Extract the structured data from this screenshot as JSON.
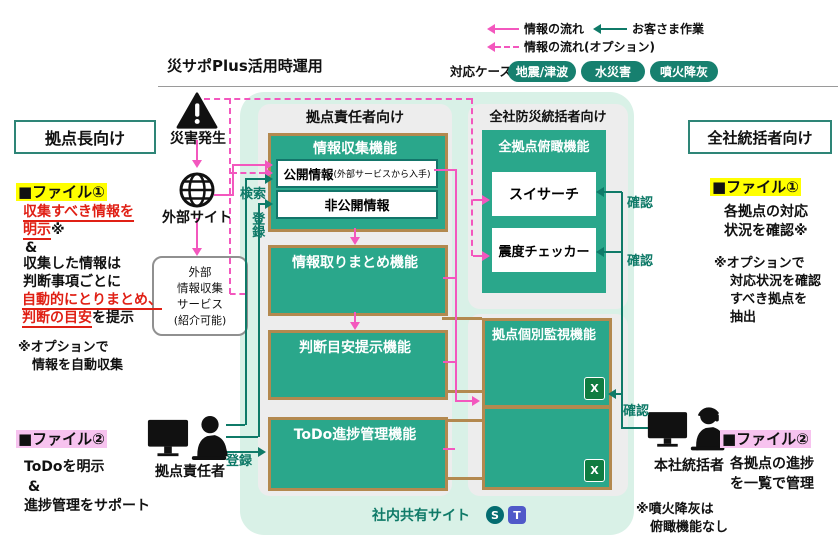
{
  "title": "災サポPlus活用時運用",
  "legend": {
    "info_flow": "情報の流れ",
    "customer_work": "お客さま作業",
    "info_flow_option": "情報の流れ(オプション)",
    "cases_label": "対応ケース：",
    "cases": [
      "地震/津波",
      "水災害",
      "噴火降灰"
    ]
  },
  "left_panel": {
    "audience": "拠点長向け",
    "file1": {
      "heading": "■ファイル①",
      "red1": "収集すべき情報を",
      "red2": "明示",
      "mark": "※",
      "amp": "&",
      "l3": "収集した情報は",
      "l4": "判断事項ごとに",
      "red3": "自動的にとりまとめ、",
      "red4": "判断の目安",
      "tail": "を提示",
      "note1": "※オプションで",
      "note2": "情報を自動収集"
    },
    "file2": {
      "heading": "■ファイル②",
      "l1": "ToDoを明示",
      "amp": "&",
      "l3": "進捗管理をサポート"
    }
  },
  "actors": {
    "disaster": "災害発生",
    "external_site": "外部サイト",
    "ext_service": [
      "外部",
      "情報収集",
      "サービス",
      "(紹介可能)"
    ],
    "site_manager": "拠点責任者",
    "hq_manager": "本社統括者"
  },
  "center_panel": {
    "header": "拠点責任者向け",
    "collect": "情報収集機能",
    "public": "公開情報",
    "public_sub": "(外部サービスから入手)",
    "private": "非公開情報",
    "summary": "情報取りまとめ機能",
    "judgment": "判断目安提示機能",
    "todo": "ToDo進捗管理機能"
  },
  "right_panel": {
    "header": "全社防災統括者向け",
    "overview": "全拠点俯瞰機能",
    "sui": "スイサーチ",
    "shindo": "震度チェッカー",
    "monitor": "拠点個別監視機能"
  },
  "right_text": {
    "audience": "全社統括者向け",
    "file1": {
      "heading": "■ファイル①",
      "l1": "各拠点の対応",
      "l2": "状況を確認※",
      "note1": "※オプションで",
      "note2": "対応状況を確認",
      "note3": "すべき拠点を",
      "note4": "抽出"
    },
    "file2": {
      "heading": "■ファイル②",
      "l1": "各拠点の進捗",
      "l2": "を一覧で管理"
    },
    "bottom_note1": "※噴火降灰は",
    "bottom_note2": "俯瞰機能なし"
  },
  "actions": {
    "search": "検索",
    "register": "登録",
    "register2": "登録",
    "confirm1": "確認",
    "confirm2": "確認",
    "confirm3": "確認"
  },
  "footer": {
    "shared_site": "社内共有サイト",
    "sharepoint_letter": "S",
    "teams_letter": "T",
    "excel_letter": "X"
  },
  "colors": {
    "teal_box": "#2aa78b",
    "teal_line": "#0f7a68",
    "pink": "#f357be",
    "tan": "#b3894f",
    "mint": "#d9f1e7",
    "panel_gray": "#ededed",
    "highlight_yellow": "#ffff00",
    "highlight_pink": "#f7c3ef",
    "red_text": "#e02015"
  }
}
